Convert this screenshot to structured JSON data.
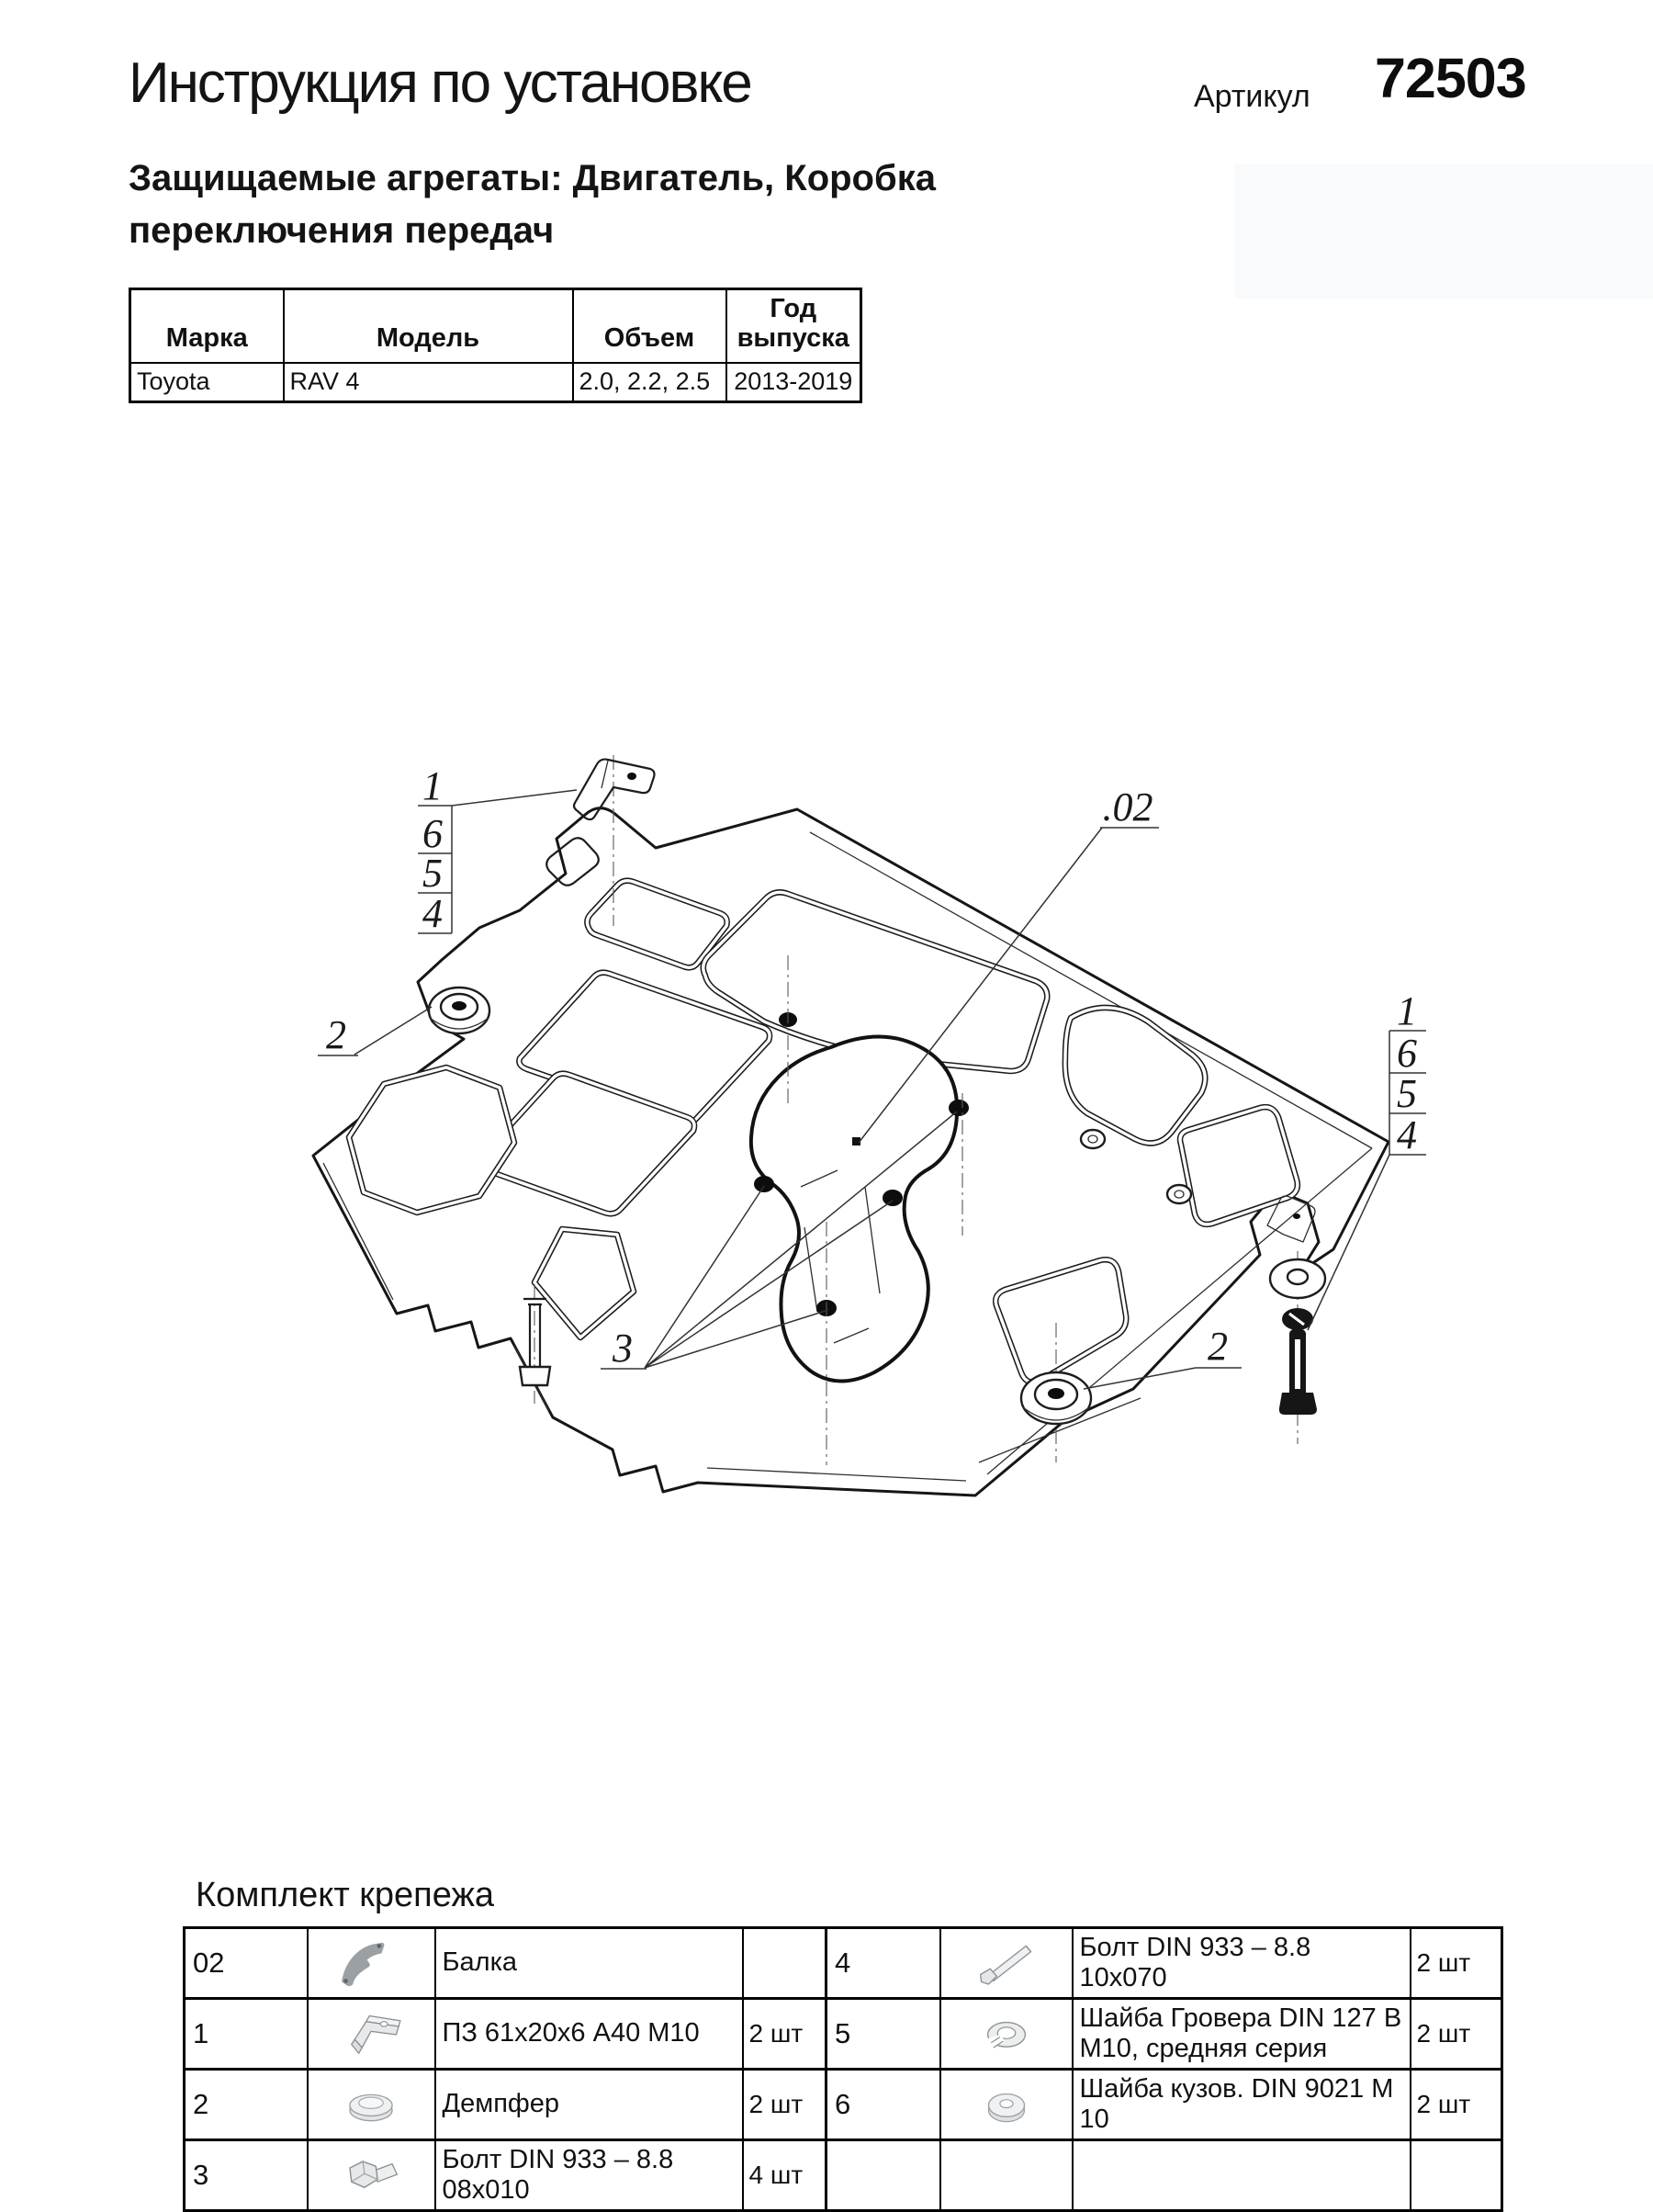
{
  "page": {
    "title": "Инструкция по установке",
    "article_label": "Артикул",
    "article_number": "72503",
    "subtitle": "Защищаемые агрегаты: Двигатель, Коробка переключения передач"
  },
  "vehicle_table": {
    "headers": [
      "Марка",
      "Модель",
      "Объем",
      "Год выпуска"
    ],
    "rows": [
      [
        "Toyota",
        "RAV 4",
        "2.0, 2.2, 2.5",
        "2013-2019"
      ]
    ]
  },
  "diagram": {
    "callout_left_stack": [
      "1",
      "6",
      "5",
      "4"
    ],
    "callout_right_stack": [
      "1",
      "6",
      "5",
      "4"
    ],
    "callout_damper_left": "2",
    "callout_damper_right": "2",
    "callout_bolts": "3",
    "callout_beam": ".02"
  },
  "fastener_kit": {
    "heading": "Комплект крепежа",
    "left_rows": [
      {
        "num": "02",
        "item": "Балка",
        "qty": "",
        "icon": "beam-part-icon"
      },
      {
        "num": "1",
        "item": "ПЗ 61х20х6 А40 М10",
        "qty": "2 шт",
        "icon": "bracket-plate-icon"
      },
      {
        "num": "2",
        "item": "Демпфер",
        "qty": "2 шт",
        "icon": "damper-icon"
      },
      {
        "num": "3",
        "item": "Болт DIN 933 – 8.8 08х010",
        "qty": "4 шт",
        "icon": "short-bolt-icon"
      }
    ],
    "right_rows": [
      {
        "num": "4",
        "item": "Болт DIN 933 – 8.8 10х070",
        "qty": "2 шт",
        "icon": "long-bolt-icon"
      },
      {
        "num": "5",
        "item": "Шайба Гровера DIN 127 В М10, средняя серия",
        "qty": "2 шт",
        "icon": "spring-washer-icon"
      },
      {
        "num": "6",
        "item": "Шайба кузов. DIN 9021 М 10",
        "qty": "2 шт",
        "icon": "flat-washer-icon"
      },
      {
        "num": "",
        "item": "",
        "qty": "",
        "icon": ""
      }
    ]
  }
}
